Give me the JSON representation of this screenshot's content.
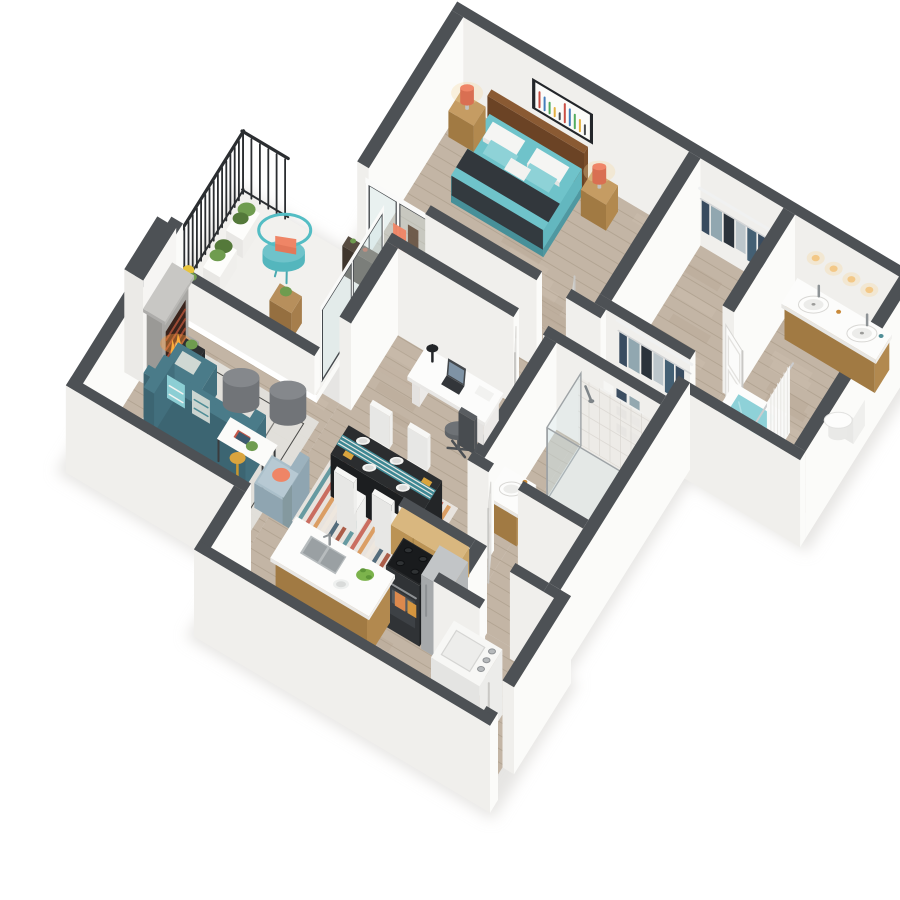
{
  "meta": {
    "type": "isometric-3d-floor-plan-render",
    "view": "one-bedroom-den-apartment",
    "background": "#ffffff"
  },
  "rooms": [
    {
      "name": "bedroom",
      "items": [
        "queen-bed",
        "dark-runner-blanket",
        "pillows",
        "headboard",
        "nightstand-left",
        "nightstand-right",
        "coral-lamp-left",
        "coral-lamp-right",
        "abstract-wall-art",
        "sliding-glass-door-to-balcony"
      ]
    },
    {
      "name": "walk-in-closet",
      "items": [
        "hanging-clothes-row-north",
        "hanging-clothes-row-south",
        "wire-shelves"
      ]
    },
    {
      "name": "master-bathroom",
      "items": [
        "double-vanity",
        "round-vessel-sinks",
        "vanity-lights",
        "toilet",
        "soaking-tub-teal-water",
        "shower-curtain",
        "door"
      ]
    },
    {
      "name": "balcony",
      "items": [
        "black-railing",
        "parapet-wall",
        "planter-boxes",
        "teal-wire-chair",
        "coral-pillow",
        "wood-cube-table",
        "console-shelf",
        "sliding-glass-door-to-living"
      ]
    },
    {
      "name": "den-office",
      "items": [
        "white-desk",
        "laptop",
        "desk-lamp",
        "office-chair",
        "door"
      ]
    },
    {
      "name": "second-bathroom",
      "items": [
        "glass-tiled-shower",
        "vanity-round-sink",
        "linen-wire-shelves",
        "door"
      ]
    },
    {
      "name": "living-room",
      "items": [
        "fireplace-with-fire",
        "teal-sectional-sofa",
        "patterned-pillows",
        "gray-ottomans",
        "white-coffee-table",
        "light-blue-armchair",
        "gold-floor-lamp",
        "side-tables",
        "area-rug",
        "plants"
      ]
    },
    {
      "name": "dining-area",
      "items": [
        "dark-dining-table",
        "teal-table-runner",
        "white-chairs",
        "place-settings",
        "striped-multicolor-rug"
      ]
    },
    {
      "name": "kitchen",
      "items": [
        "island-with-double-sink",
        "faucet",
        "fruit-bowl",
        "bar-stools",
        "black-range",
        "orange-towel",
        "stainless-refrigerator",
        "upper-wood-cabinets"
      ]
    },
    {
      "name": "entry-laundry",
      "items": [
        "open-front-door",
        "washer",
        "coat-closet-clothes"
      ]
    }
  ],
  "colors": {
    "bg": "#ffffff",
    "cap": "#4d5155",
    "wallLit": "#fbfbf9",
    "wallShade": "#f0efec",
    "floor": "#c3b5a5",
    "floorLine": "#a2937f",
    "floorDark": "#ab9b89",
    "floorLight": "#d4c8b9",
    "concrete": "#deddd8",
    "concreteLine": "#c9c8c3",
    "railing": "#2b2e31",
    "glass": "#cfe2e5",
    "glassFrame": "#45494d",
    "teal": "#6fc3ca",
    "tealLight": "#8ed2d7",
    "tealDeep": "#57a5ae",
    "sofaTop": "#4a7b89",
    "sofaSide": "#426f7d",
    "sofaDark": "#3c6572",
    "runner": "#32373c",
    "headboard": "#8a5a33",
    "woodLight": "#c59c63",
    "woodMid": "#b2894f",
    "woodDark": "#a17a43",
    "cabinetLight": "#d9b77f",
    "cabinetMid": "#caa568",
    "cabinetDark": "#bb9355",
    "coral": "#ef8566",
    "coralDark": "#d96f52",
    "white": "#fcfcfb",
    "offWhite": "#f1f0ee",
    "grayMid": "#85888c",
    "grayDark": "#717478",
    "charcoal": "#2b2d2f",
    "black": "#1c1e20",
    "stainless": "#c2c5c7",
    "stainlessDark": "#a6a9ab",
    "rugLiving": "#e3e1dc",
    "rugBase": "#eae6e0",
    "water": "#8ed1d8",
    "tile": "#eceae6",
    "tileLine": "#d8d5d0",
    "flame": "#ffb03c",
    "flameLight": "#ffd878",
    "ember": "#ff9c3f",
    "brick": "#b0523a",
    "firebox": "#3a241c",
    "glow": "#f7dba2",
    "gold": "#d9a43e",
    "plant": "#6f9c4f",
    "plantDark": "#54793a",
    "armchair": "#aabfca",
    "armchairDark": "#8fa5b1",
    "chairWhite": "#f7f7f5",
    "artFrame": "#23262a",
    "shadow": "#d2d0cc"
  },
  "garments": [
    "#31455a",
    "#8da3ad",
    "#222b33",
    "#b9c4c9",
    "#3c5a6e"
  ],
  "rugStripes": [
    "#4f8d96",
    "#c4584a",
    "#d8924f",
    "#efe8de",
    "#39576b",
    "#a0452f"
  ],
  "art": [
    "#c33b2f",
    "#2f6fb3",
    "#3fa34d",
    "#e0a92e",
    "#33363a"
  ]
}
